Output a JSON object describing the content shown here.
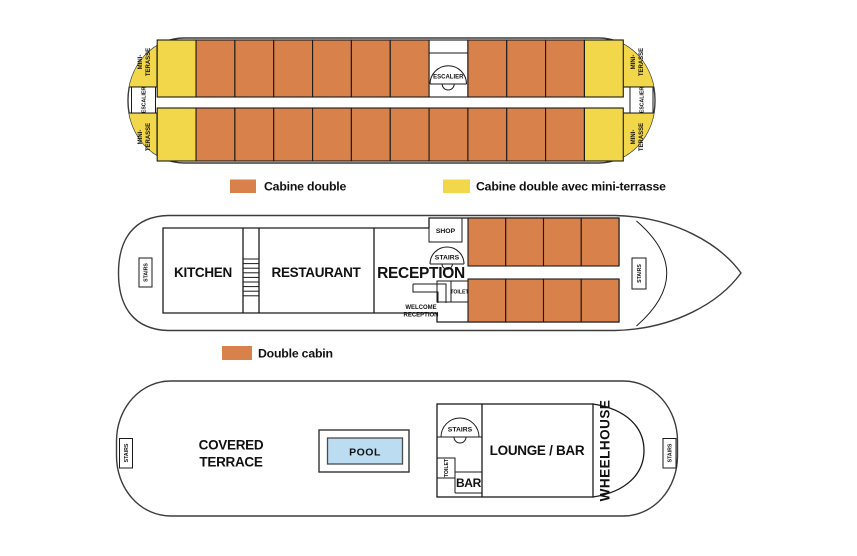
{
  "colors": {
    "cabin": "#D8814A",
    "mini_terrace": "#F2D74B",
    "pool": "#BCDCF2",
    "wall": "#1a1a1a"
  },
  "upper_deck": {
    "mini_terrace_line1": "MINI-",
    "mini_terrace_line2": "TERASSE",
    "stairs_fr": "ESCALIER",
    "row_upper": [
      "terrace",
      "cabin",
      "cabin",
      "cabin",
      "cabin",
      "cabin",
      "cabin",
      "stairs",
      "cabin",
      "cabin",
      "cabin",
      "terrace"
    ],
    "row_lower": [
      "terrace",
      "cabin",
      "cabin",
      "cabin",
      "cabin",
      "cabin",
      "cabin",
      "cabin",
      "cabin",
      "cabin",
      "cabin",
      "terrace"
    ]
  },
  "legend_upper": {
    "items": [
      {
        "label": "Cabine double",
        "color": "#D8814A"
      },
      {
        "label": "Cabine double avec mini-terrasse",
        "color": "#F2D74B"
      }
    ]
  },
  "main_deck": {
    "stairs_left": "STAIRS",
    "kitchen": "KITCHEN",
    "restaurant": "RESTAURANT",
    "reception": "RECEPTION",
    "shop": "SHOP",
    "stairs_mid": "STAIRS",
    "toilet": "TOILET",
    "welcome_line1": "WELCOME",
    "welcome_line2": "RECEPTION",
    "stairs_bow": "STAIRS",
    "cabin_grid": {
      "rows": 2,
      "cols": 4
    }
  },
  "legend_main": {
    "items": [
      {
        "label": "Double cabin",
        "color": "#D8814A"
      }
    ]
  },
  "sun_deck": {
    "stairs_left": "STAIRS",
    "covered_line1": "COVERED",
    "covered_line2": "TERRACE",
    "pool": "POOL",
    "stairs_mid": "STAIRS",
    "toilet": "TOILET",
    "bar": "BAR",
    "lounge_bar": "LOUNGE / BAR",
    "wheelhouse": "WHEELHOUSE",
    "stairs_right": "STAIRS"
  }
}
